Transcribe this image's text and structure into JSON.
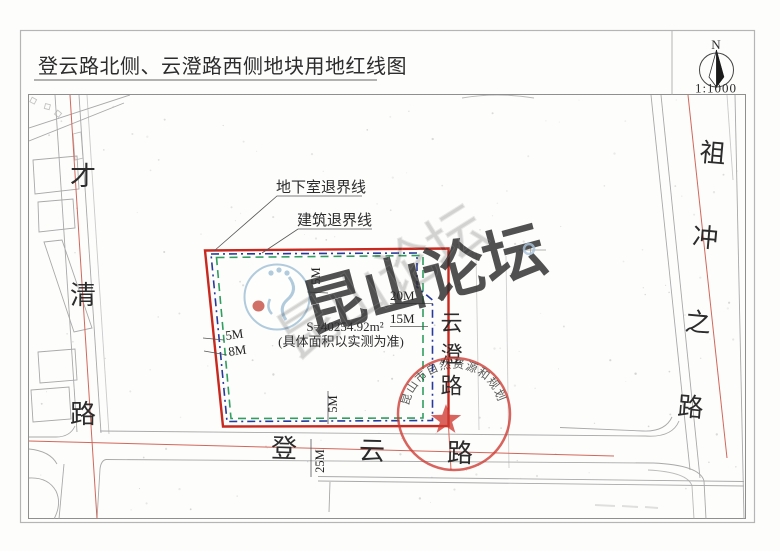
{
  "sheet": {
    "title": "登云路北侧、云澄路西侧地块用地红线图",
    "north_label": "N",
    "scale": "1:1000"
  },
  "map": {
    "roads": {
      "west": "才清路",
      "east": "祖冲之路",
      "south": "登云路",
      "center": "云澄路"
    },
    "boundary": {
      "area_line1": "S=40254.92m²",
      "area_line2": "(具体面积以实测为准)",
      "basement_setback_label": "地下室退界线",
      "building_setback_label": "建筑退界线"
    },
    "dimensions": {
      "top_inset": "5M",
      "right_upper": "20M",
      "right_lower": "15M",
      "left_upper": "5M",
      "left_lower": "8M",
      "bottom_inset": "5M",
      "road_width": "25M"
    },
    "colors": {
      "red_line": "#c8281e",
      "road_centerline": "#d4665a",
      "building_setback": "#2f9e5f",
      "basement_setback": "#27399b",
      "map_gray": "#a9a9a9"
    }
  },
  "stamp": {
    "agency": "昆山市自然资源和规划局",
    "color": "#cf3a32"
  },
  "watermark": {
    "text": "昆山论坛",
    "color": "#a9c4db"
  }
}
